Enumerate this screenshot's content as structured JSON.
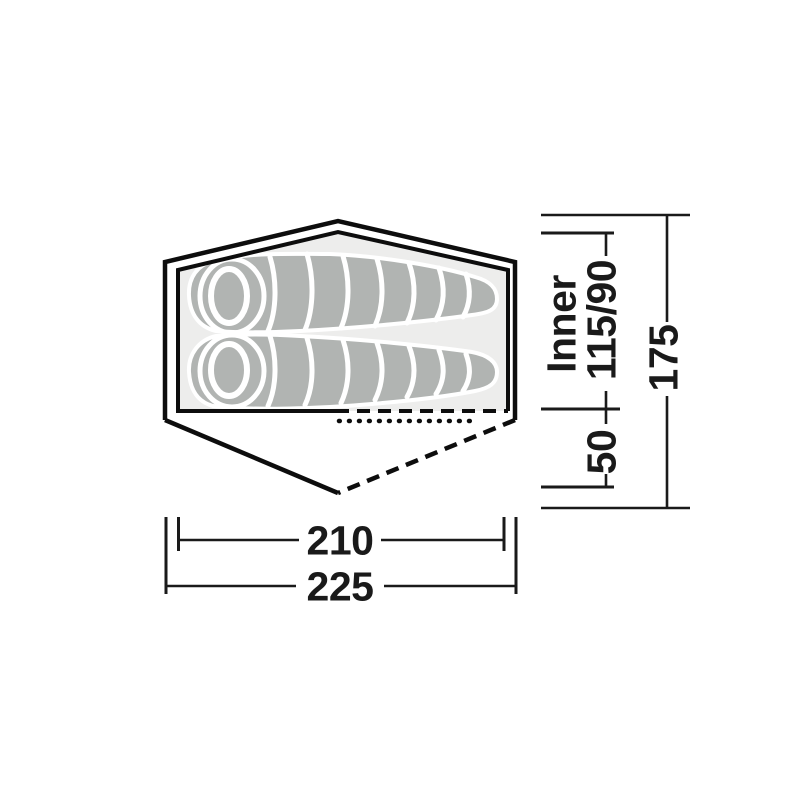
{
  "diagram": {
    "dimensions": {
      "inner_label": "Inner",
      "inner_width": "115/90",
      "vestibule_depth": "50",
      "total_width": "175",
      "inner_length": "210",
      "total_length": "225"
    },
    "colors": {
      "outline": "#0d0d0d",
      "dimension_text": "#1a1a1a",
      "inner_floor": "#ededec",
      "sleeping_bag": "#b1b4b2",
      "background": "#ffffff"
    }
  }
}
